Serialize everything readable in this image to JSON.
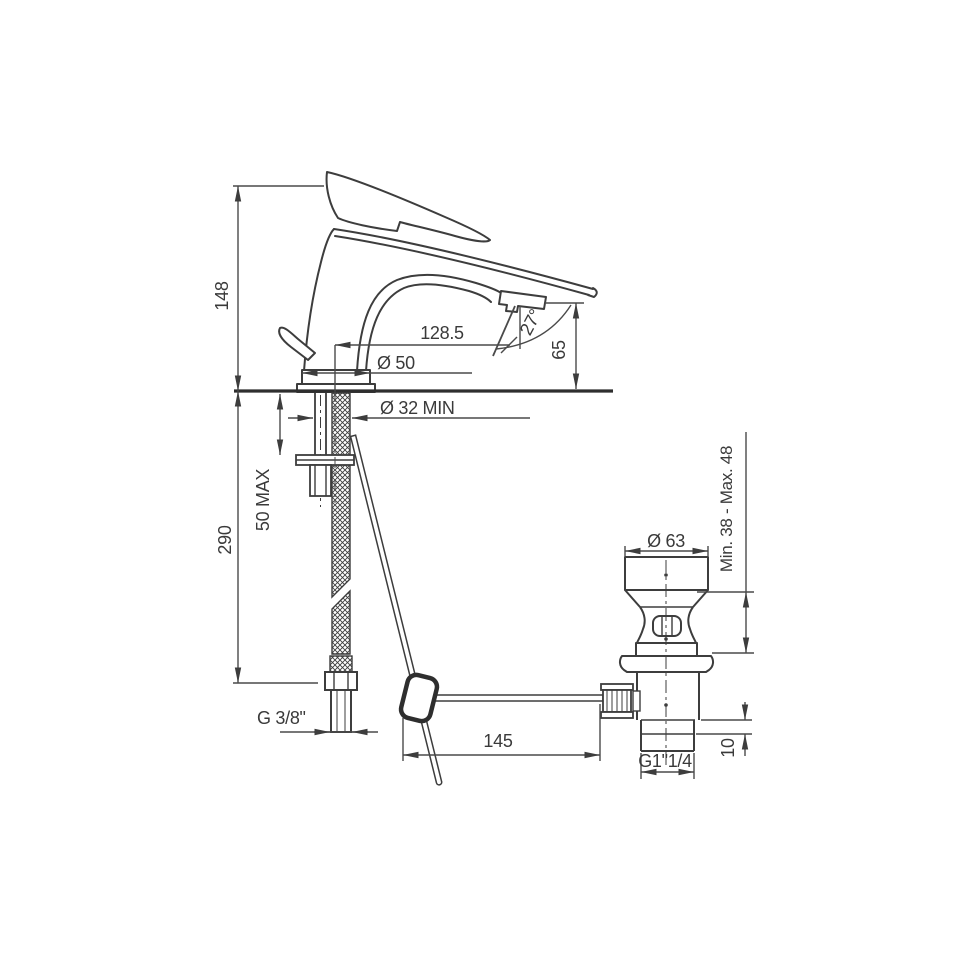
{
  "drawing": {
    "type": "technical-dimension-drawing",
    "subject": "single-lever basin mixer tap with flexible supply hose and pop-up waste drain, side elevation",
    "line_color": "#3d3d3d",
    "background": "#ffffff",
    "labels": {
      "height_total": "148",
      "height_below_deck": "290",
      "deck_thickness_max": "50 MAX",
      "spout_reach": "128.5",
      "spout_angle": "27°",
      "spout_height": "65",
      "base_diameter": "Ø 50",
      "hole_diameter": "Ø 32 MIN",
      "supply_thread": "G 3/8\"",
      "rod_length": "145",
      "waste_flange_diameter": "Ø 63",
      "basin_clamp_range": "Min. 38 - Max. 48",
      "waste_thread": "G1\"1/4",
      "tail_length": "10"
    }
  }
}
